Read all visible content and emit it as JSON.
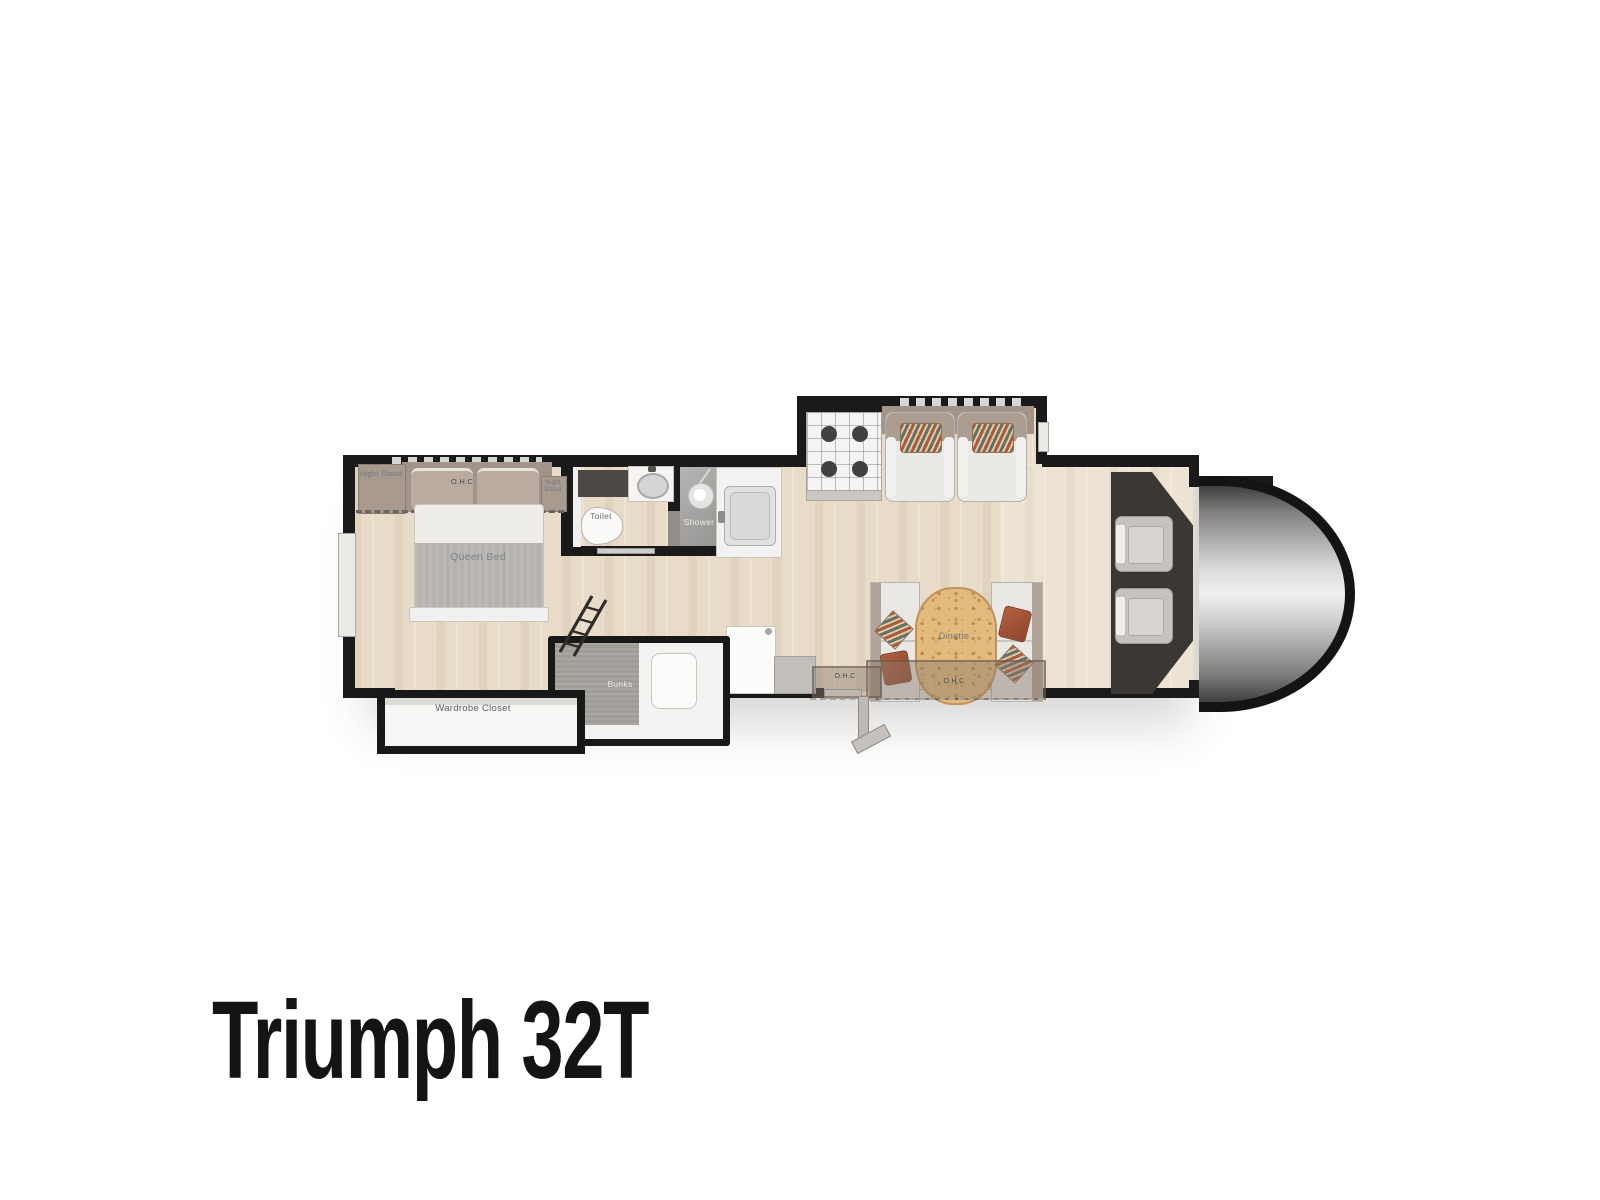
{
  "title": "Triumph 32T",
  "plan": {
    "labels": {
      "night_stand_left": "Night Stand",
      "night_stand_right": "Night Stand",
      "ohc_bedroom": "O.H.C",
      "queen_bed": "Queen Bed",
      "toilet": "Toilet",
      "shower": "Shower",
      "wardrobe_closet": "Wardrobe Closet",
      "bunks": "Bunks",
      "dinette": "Dinette",
      "ohc_galley": "O.H.C",
      "ohc_dinette": "O.H.C"
    },
    "colors": {
      "wall": "#1a1a1a",
      "floor_wood": "#e8dcc8",
      "label_text": "#6e7984",
      "upholstery_taupe": "#a89a8e",
      "dinette_table_wood": "#e3ba7e",
      "pillow_rust": "#a6513a",
      "shower_gray": "#a7a5a3",
      "cab_dashboard": "#3a3734",
      "cab_nose_metal": "#d7d7d7",
      "title_text": "#141414"
    }
  }
}
